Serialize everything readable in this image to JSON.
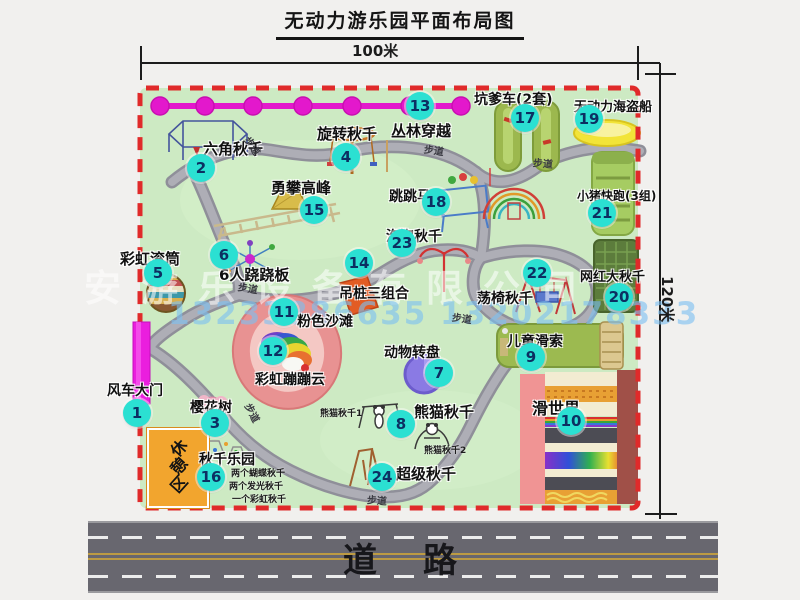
{
  "title": "无动力游乐园平面布局图",
  "dimensions": {
    "width_label": "100米",
    "height_label": "120米"
  },
  "road": {
    "label": "道　路"
  },
  "watermark": {
    "company": "安游乐设备有限公司",
    "phone": "13233886635 13202178333"
  },
  "rest_area": {
    "label": "休憩区"
  },
  "walkway_label": "步道",
  "colors": {
    "map_green": "#cdeac3",
    "border_red": "#e02a2a",
    "path_gray": "#8f8f99",
    "marker": "#2be0d2",
    "marker_text": "#0c2f62",
    "gate_magenta": "#ea1ede",
    "chain_magenta": "#e318cc",
    "rest_orange": "#f2a52e",
    "road_gray": "#68676f",
    "watermark_blue": "#7dc0f0"
  },
  "attractions": [
    {
      "n": "1",
      "name": "风车大门",
      "mx": 137,
      "my": 413,
      "tx": 107,
      "ty": 380,
      "fs": 14
    },
    {
      "n": "2",
      "name": "六角秋千",
      "mx": 201,
      "my": 168,
      "tx": 203,
      "ty": 138,
      "fs": 15
    },
    {
      "n": "3",
      "name": "樱花树",
      "mx": 215,
      "my": 423,
      "tx": 190,
      "ty": 397,
      "fs": 14
    },
    {
      "n": "4",
      "name": "旋转秋千",
      "mx": 346,
      "my": 157,
      "tx": 317,
      "ty": 123,
      "fs": 15
    },
    {
      "n": "5",
      "name": "彩虹滚筒",
      "mx": 158,
      "my": 273,
      "tx": 120,
      "ty": 248,
      "fs": 15
    },
    {
      "n": "6",
      "name": "6人跷跷板",
      "mx": 224,
      "my": 255,
      "tx": 219,
      "ty": 264,
      "fs": 15
    },
    {
      "n": "7",
      "name": "动物转盘",
      "mx": 439,
      "my": 373,
      "tx": 384,
      "ty": 342,
      "fs": 14
    },
    {
      "n": "8",
      "name": "熊猫秋千",
      "mx": 401,
      "my": 424,
      "tx": 414,
      "ty": 401,
      "fs": 15
    },
    {
      "n": "9",
      "name": "儿童滑索",
      "mx": 531,
      "my": 357,
      "tx": 507,
      "ty": 331,
      "fs": 14
    },
    {
      "n": "10",
      "name": "滑世界",
      "mx": 571,
      "my": 421,
      "tx": 532,
      "ty": 395,
      "fs": 16
    },
    {
      "n": "11",
      "name": "粉色沙滩",
      "mx": 284,
      "my": 312,
      "tx": 297,
      "ty": 311,
      "fs": 14
    },
    {
      "n": "12",
      "name": "彩虹蹦蹦云",
      "mx": 273,
      "my": 351,
      "tx": 255,
      "ty": 369,
      "fs": 14
    },
    {
      "n": "13",
      "name": "丛林穿越",
      "mx": 420,
      "my": 106,
      "tx": 391,
      "ty": 120,
      "fs": 15
    },
    {
      "n": "14",
      "name": "吊桩三组合",
      "mx": 359,
      "my": 263,
      "tx": 339,
      "ty": 283,
      "fs": 14
    },
    {
      "n": "15",
      "name": "勇攀高峰",
      "mx": 314,
      "my": 210,
      "tx": 271,
      "ty": 177,
      "fs": 15
    },
    {
      "n": "16",
      "name": "秋千乐园",
      "mx": 211,
      "my": 477,
      "tx": 199,
      "ty": 449,
      "fs": 14
    },
    {
      "n": "17",
      "name": "坑爹车(2套)",
      "mx": 525,
      "my": 118,
      "tx": 474,
      "ty": 89,
      "fs": 14
    },
    {
      "n": "18",
      "name": "跳跳马",
      "mx": 436,
      "my": 202,
      "tx": 389,
      "ty": 186,
      "fs": 14
    },
    {
      "n": "19",
      "name": "无动力海盗船",
      "mx": 589,
      "my": 119,
      "tx": 574,
      "ty": 96,
      "fs": 13
    },
    {
      "n": "20",
      "name": "网红大秋千",
      "mx": 619,
      "my": 297,
      "tx": 580,
      "ty": 266,
      "fs": 13
    },
    {
      "n": "21",
      "name": "小猪快跑(3组)",
      "mx": 602,
      "my": 213,
      "tx": 577,
      "ty": 187,
      "fs": 12
    },
    {
      "n": "22",
      "name": "荡椅秋千",
      "mx": 537,
      "my": 273,
      "tx": 477,
      "ty": 288,
      "fs": 14
    },
    {
      "n": "23",
      "name": "泡泡秋千",
      "mx": 402,
      "my": 243,
      "tx": 386,
      "ty": 226,
      "fs": 14
    },
    {
      "n": "24",
      "name": "超级秋千",
      "mx": 382,
      "my": 477,
      "tx": 396,
      "ty": 463,
      "fs": 15
    }
  ],
  "sub_labels": [
    {
      "text": "熊猫秋千1",
      "x": 320,
      "y": 406,
      "fs": 9
    },
    {
      "text": "熊猫秋千2",
      "x": 424,
      "y": 443,
      "fs": 9
    },
    {
      "text": "两个蝴蝶秋千",
      "x": 231,
      "y": 466,
      "fs": 9
    },
    {
      "text": "两个发光秋千",
      "x": 229,
      "y": 479,
      "fs": 9
    },
    {
      "text": "一个彩虹秋千",
      "x": 232,
      "y": 492,
      "fs": 9
    }
  ],
  "walkways": [
    {
      "x": 243,
      "y": 138,
      "rot": 55
    },
    {
      "x": 424,
      "y": 142,
      "rot": 8
    },
    {
      "x": 533,
      "y": 155,
      "rot": 5
    },
    {
      "x": 238,
      "y": 280,
      "rot": 10
    },
    {
      "x": 452,
      "y": 310,
      "rot": 8
    },
    {
      "x": 243,
      "y": 405,
      "rot": 62
    },
    {
      "x": 367,
      "y": 492,
      "rot": 4
    }
  ]
}
